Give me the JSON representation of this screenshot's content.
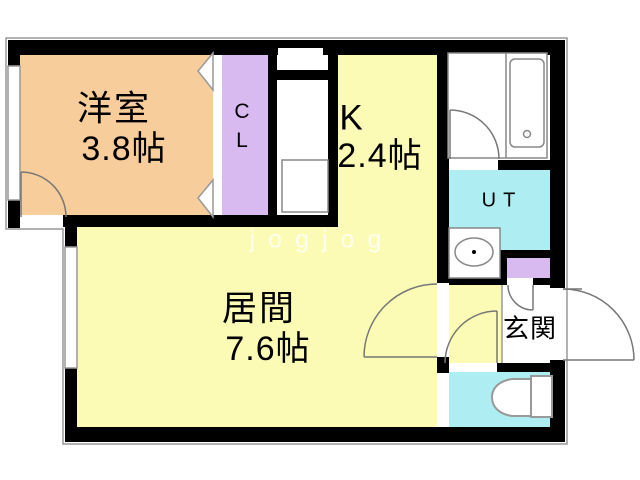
{
  "floorplan": {
    "watermark": "jogjog",
    "rooms": {
      "western_room": {
        "name": "洋室",
        "size": "3.8帖"
      },
      "closet": {
        "line1": "C",
        "line2": "L"
      },
      "kitchen": {
        "name": "K",
        "size": "2.4帖"
      },
      "utility": {
        "name": "UT"
      },
      "living": {
        "name": "居間",
        "size": "7.6帖"
      },
      "entrance": {
        "name": "玄関"
      }
    },
    "colors": {
      "western_room_floor": "#F8CD9C",
      "closet_floor": "#D8BAF0",
      "kitchen_living_floor": "#FBFBB6",
      "wet_area_floor": "#AEEDF2",
      "shoe_cabinet": "#D8BAF0",
      "wall": "#000000",
      "fixture_line": "#888888",
      "floor_white": "#FFFFFF"
    }
  }
}
